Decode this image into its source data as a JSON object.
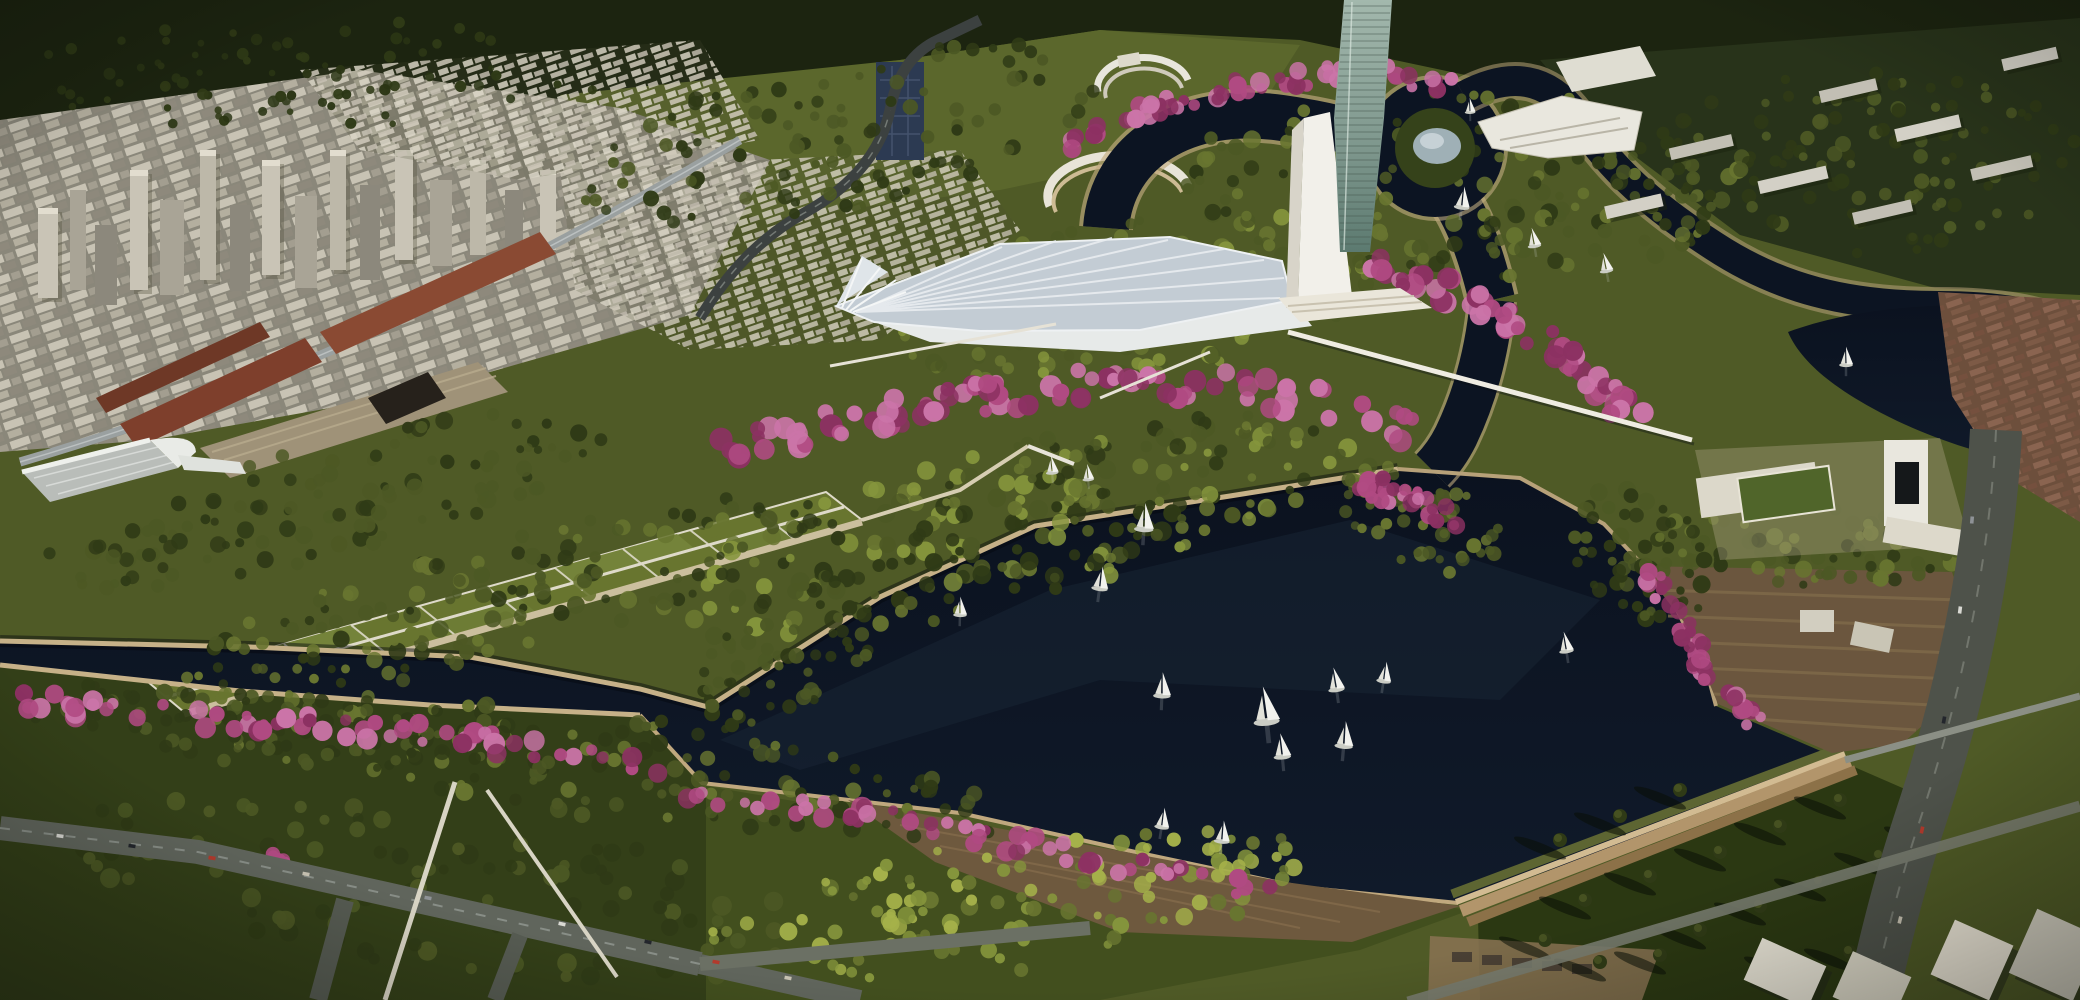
{
  "meta": {
    "title": "Aerial rendering — lakefront park and city",
    "description": "Late-afternoon aerial architectural rendering: dense city skyline at upper left, dark navy lake with sailboats, park peninsula lined with pink blossoming trees, white fan-shaped canopy pavilion with white mast and glass tower, winding river channels around a domed island at upper right, formal gardens, terraced levee embankment, museum complex and fields at lower right.",
    "width": 2080,
    "height": 1000
  },
  "palette": {
    "base": "#4f5a26",
    "forest": "#1c2410",
    "hills": "#5b672c",
    "town_dark": "#28331a",
    "field_sw": "#333f18",
    "lawn_bc": "#424f1e",
    "field_se": "#2b3812",
    "water_top": "#0b121f",
    "water_bot": "#101a2a",
    "water_hl": "#1b2738",
    "shore_shadow": "#04070d",
    "embank_light": "#c6b188",
    "embank_mid": "#b7a179",
    "embank_warm": "#c0a87e",
    "levee_rubble": "#5d6532",
    "levee_1": "#d2bb92",
    "levee_2": "#b2956b",
    "levee_3": "#8c7148",
    "plaza_brown": "#6e593e",
    "plaza_hatch": "#81694a",
    "slope_brown": "#6b563e",
    "slope_hatch": "#7f6a4a",
    "strip_tan": "#8a7354",
    "city_base": "#8a877a",
    "city_light": "#cbc6b6",
    "city_mid": "#a8a395",
    "city_dark": "#7d7970",
    "city_cap": "#e2ddcf",
    "brick_a": "#7e3f2c",
    "brick_b": "#8a4a33",
    "brick_c": "#6e3826",
    "shed_tan": "#9f9278",
    "cube_dark": "#26211b",
    "glass_blue": "#2c3a52",
    "road": "#60655c",
    "road_dark": "#3c4140",
    "road_line": "#9aa09a",
    "path_white": "#e6e2d6",
    "path_tan": "#d6cdb2",
    "garden_bed": "#68752f",
    "garden_bed2": "#74833a",
    "garden_line": "#dedac9",
    "canopy_deck": "#c3ccd4",
    "canopy_rib": "#e9edf0",
    "white": "#f2f0ea",
    "mast_shade": "#d8d4c9",
    "plinth": "#eae6da",
    "glass_1": "#a3b8ad",
    "glass_2": "#5c7a70",
    "glass_line": "#46584f",
    "dome": "#9fb0b6",
    "bldg_white": "#e9e7de",
    "bldg_off": "#dcd8ca",
    "roof_slot": "#15181a",
    "lawn_court": "#50652a",
    "tree_dark": "#2f3a16",
    "tree_mid": "#4c5824",
    "tree_olive": "#687530",
    "tree_light": "#85953c",
    "tree_yellow": "#a5b14a",
    "forest_hi": "#2a3514",
    "blossom": "#b04a82",
    "blossom_light": "#cb74a8",
    "blossom_deep": "#8c3162",
    "sail": "#f2f2ee",
    "hull": "#caccc4"
  },
  "scene": {
    "landmark_labels": {
      "tower": "glass high-rise tower",
      "mast": "white mast monument",
      "canopy": "fan canopy pavilion",
      "island": "domed island",
      "museum": "museum complex",
      "gardens": "formal gardens",
      "levee": "terraced levee",
      "boardwalk": "boardwalk plaza",
      "pier": "marina pier",
      "bridge": "footbridge"
    },
    "boats": [
      [
        1144,
        525,
        1.0
      ],
      [
        1100,
        585,
        0.85
      ],
      [
        960,
        612,
        0.7
      ],
      [
        1162,
        692,
        0.9
      ],
      [
        1222,
        838,
        0.8
      ],
      [
        1162,
        824,
        0.75
      ],
      [
        1282,
        753,
        0.9
      ],
      [
        1266,
        716,
        1.35
      ],
      [
        1344,
        742,
        0.95
      ],
      [
        1336,
        686,
        0.85
      ],
      [
        1384,
        678,
        0.75
      ],
      [
        1052,
        470,
        0.65
      ],
      [
        1088,
        477,
        0.6
      ],
      [
        1462,
        204,
        0.8
      ],
      [
        1534,
        243,
        0.7
      ],
      [
        1606,
        268,
        0.7
      ],
      [
        1470,
        110,
        0.55
      ],
      [
        1846,
        362,
        0.7
      ],
      [
        1566,
        648,
        0.75
      ]
    ],
    "cars": [
      [
        60,
        836,
        8
      ],
      [
        132,
        846,
        8
      ],
      [
        212,
        858,
        9
      ],
      [
        306,
        874,
        10
      ],
      [
        428,
        898,
        11
      ],
      [
        562,
        924,
        12
      ],
      [
        648,
        942,
        12
      ],
      [
        716,
        962,
        10
      ],
      [
        788,
        978,
        11
      ],
      [
        1972,
        520,
        -85
      ],
      [
        1960,
        610,
        -83
      ],
      [
        1944,
        720,
        -80
      ],
      [
        1922,
        830,
        -78
      ],
      [
        1900,
        920,
        -76
      ]
    ],
    "car_colors": [
      "#d9d9d3",
      "#23262c",
      "#b23a2c",
      "#c7c2b2",
      "#8e9296"
    ],
    "tree_clusters": [
      {
        "x": 1000,
        "y": 528,
        "rx": 360,
        "ry": 78,
        "rot": -14,
        "n": 240,
        "rmin": 4,
        "rmax": 10,
        "colors": [
          "tree_dark",
          "tree_mid",
          "tree_olive",
          "tree_light"
        ],
        "seed": 11
      },
      {
        "x": 490,
        "y": 600,
        "rx": 340,
        "ry": 58,
        "rot": -15,
        "n": 150,
        "rmin": 4,
        "rmax": 9,
        "colors": [
          "tree_dark",
          "tree_mid",
          "tree_olive"
        ],
        "seed": 12
      },
      {
        "x": 330,
        "y": 500,
        "rx": 300,
        "ry": 55,
        "rot": -14,
        "n": 120,
        "rmin": 4,
        "rmax": 9,
        "colors": [
          "tree_dark",
          "tree_mid"
        ],
        "seed": 13
      },
      {
        "x": 1140,
        "y": 298,
        "rx": 255,
        "ry": 78,
        "rot": -8,
        "n": 150,
        "rmin": 4,
        "rmax": 9,
        "colors": [
          "tree_mid",
          "tree_olive",
          "tree_light"
        ],
        "seed": 14
      },
      {
        "x": 1470,
        "y": 185,
        "rx": 300,
        "ry": 95,
        "rot": 0,
        "n": 180,
        "rmin": 4,
        "rmax": 9,
        "colors": [
          "tree_dark",
          "tree_mid",
          "tree_olive"
        ],
        "seed": 15
      },
      {
        "x": 1810,
        "y": 545,
        "rx": 160,
        "ry": 40,
        "rot": 3,
        "n": 90,
        "rmin": 4,
        "rmax": 9,
        "colors": [
          "tree_dark",
          "tree_mid",
          "tree_olive"
        ],
        "seed": 16
      },
      {
        "x": 1640,
        "y": 555,
        "rx": 80,
        "ry": 55,
        "rot": 40,
        "n": 55,
        "rmin": 4,
        "rmax": 9,
        "colors": [
          "tree_dark",
          "tree_mid"
        ],
        "seed": 17
      },
      {
        "x": 1855,
        "y": 165,
        "rx": 225,
        "ry": 100,
        "rot": -5,
        "n": 120,
        "rmin": 4,
        "rmax": 8,
        "colors": [
          "tree_dark",
          "tree_mid"
        ],
        "seed": 18
      },
      {
        "x": 600,
        "y": 765,
        "rx": 430,
        "ry": 52,
        "rot": 7,
        "n": 140,
        "rmin": 4,
        "rmax": 9,
        "colors": [
          "tree_dark",
          "tree_mid",
          "tree_olive"
        ],
        "seed": 19
      },
      {
        "x": 300,
        "y": 730,
        "rx": 300,
        "ry": 40,
        "rot": 6,
        "n": 80,
        "rmin": 4,
        "rmax": 8,
        "colors": [
          "tree_dark",
          "tree_mid"
        ],
        "seed": 20
      },
      {
        "x": 430,
        "y": 888,
        "rx": 380,
        "ry": 80,
        "rot": 8,
        "n": 100,
        "rmin": 5,
        "rmax": 10,
        "colors": [
          "tree_dark",
          "tree_mid"
        ],
        "seed": 21
      },
      {
        "x": 1010,
        "y": 905,
        "rx": 310,
        "ry": 66,
        "rot": -8,
        "n": 120,
        "rmin": 4,
        "rmax": 9,
        "colors": [
          "tree_yellow",
          "tree_light",
          "tree_olive"
        ],
        "seed": 22
      },
      {
        "x": 840,
        "y": 135,
        "rx": 270,
        "ry": 75,
        "rot": -12,
        "n": 100,
        "rmin": 4,
        "rmax": 8,
        "colors": [
          "tree_mid",
          "tree_dark"
        ],
        "seed": 23
      },
      {
        "x": 790,
        "y": 650,
        "rx": 120,
        "ry": 55,
        "rot": -35,
        "n": 70,
        "rmin": 4,
        "rmax": 8,
        "colors": [
          "tree_dark",
          "tree_mid"
        ],
        "seed": 24
      },
      {
        "x": 310,
        "y": 75,
        "rx": 300,
        "ry": 55,
        "rot": 0,
        "n": 80,
        "rmin": 3,
        "rmax": 6,
        "colors": [
          "forest_hi",
          "tree_dark"
        ],
        "seed": 25
      },
      {
        "x": 1420,
        "y": 520,
        "rx": 90,
        "ry": 45,
        "rot": 25,
        "n": 50,
        "rmin": 4,
        "rmax": 8,
        "colors": [
          "tree_mid",
          "tree_olive"
        ],
        "seed": 26
      }
    ],
    "blossom_rows": [
      {
        "pts": [
          [
            10,
            700
          ],
          [
            240,
            720
          ],
          [
            430,
            732
          ],
          [
            620,
            762
          ],
          [
            706,
            800
          ],
          [
            900,
            820
          ],
          [
            1100,
            860
          ],
          [
            1290,
            892
          ]
        ],
        "n": 120,
        "rmin": 5,
        "rmax": 11,
        "spread": 11,
        "seed": 31
      },
      {
        "pts": [
          [
            718,
            452
          ],
          [
            850,
            420
          ],
          [
            980,
            398
          ],
          [
            1100,
            382
          ],
          [
            1230,
            386
          ],
          [
            1330,
            404
          ],
          [
            1412,
            430
          ]
        ],
        "n": 95,
        "rmin": 6,
        "rmax": 12,
        "spread": 15,
        "seed": 32
      },
      {
        "pts": [
          [
            1062,
            148
          ],
          [
            1150,
            108
          ],
          [
            1250,
            84
          ],
          [
            1360,
            70
          ],
          [
            1452,
            86
          ]
        ],
        "n": 65,
        "rmin": 5,
        "rmax": 10,
        "spread": 9,
        "seed": 33
      },
      {
        "pts": [
          [
            1372,
            258
          ],
          [
            1452,
            292
          ],
          [
            1532,
            332
          ],
          [
            1594,
            378
          ],
          [
            1636,
            422
          ]
        ],
        "n": 60,
        "rmin": 6,
        "rmax": 12,
        "spread": 13,
        "seed": 34
      },
      {
        "pts": [
          [
            1648,
            572
          ],
          [
            1690,
            634
          ],
          [
            1712,
            690
          ],
          [
            1760,
            724
          ]
        ],
        "n": 38,
        "rmin": 5,
        "rmax": 10,
        "spread": 9,
        "seed": 35
      },
      {
        "pts": [
          [
            272,
            854
          ],
          [
            286,
            862
          ]
        ],
        "n": 6,
        "rmin": 5,
        "rmax": 9,
        "spread": 5,
        "seed": 36
      },
      {
        "pts": [
          [
            1360,
            480
          ],
          [
            1420,
            505
          ],
          [
            1460,
            525
          ]
        ],
        "n": 28,
        "rmin": 5,
        "rmax": 10,
        "spread": 12,
        "seed": 37
      }
    ],
    "shadow_trees": [
      [
        1560,
        840
      ],
      [
        1620,
        816
      ],
      [
        1680,
        790
      ],
      [
        1585,
        900
      ],
      [
        1650,
        876
      ],
      [
        1720,
        852
      ],
      [
        1780,
        826
      ],
      [
        1840,
        800
      ],
      [
        1700,
        930
      ],
      [
        1760,
        906
      ],
      [
        1820,
        882
      ],
      [
        1880,
        856
      ],
      [
        1930,
        830
      ],
      [
        1545,
        940
      ],
      [
        1850,
        952
      ],
      [
        1790,
        960
      ],
      [
        1660,
        955
      ],
      [
        1600,
        962
      ]
    ]
  }
}
